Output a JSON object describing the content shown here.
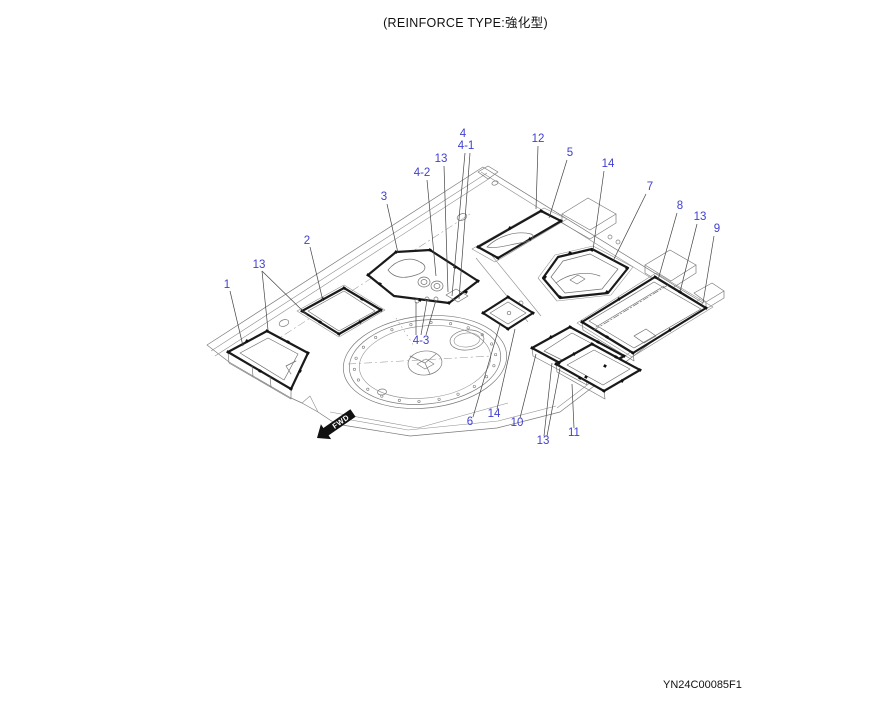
{
  "title": "(REINFORCE TYPE:強化型)",
  "drawing_number": "YN24C00085F1",
  "fwd_arrow": {
    "label": "FWD"
  },
  "colors": {
    "callout": "#4040d0",
    "line_thin": "#7a7a7a",
    "line_bold": "#1a1a1a",
    "background": "#ffffff"
  },
  "callouts": [
    {
      "label": "1",
      "x": 227,
      "y": 288,
      "leaders": [
        [
          230,
          291,
          243,
          346
        ]
      ]
    },
    {
      "label": "13",
      "x": 259,
      "y": 268,
      "leaders": [
        [
          262,
          271,
          268,
          330
        ],
        [
          262,
          271,
          308,
          316
        ]
      ]
    },
    {
      "label": "2",
      "x": 307,
      "y": 244,
      "leaders": [
        [
          310,
          247,
          323,
          301
        ]
      ]
    },
    {
      "label": "3",
      "x": 384,
      "y": 200,
      "leaders": [
        [
          387,
          204,
          398,
          253
        ]
      ]
    },
    {
      "label": "4-2",
      "x": 422,
      "y": 176,
      "leaders": [
        [
          427,
          180,
          436,
          276
        ]
      ]
    },
    {
      "label": "13",
      "x": 441,
      "y": 162,
      "leaders": [
        [
          444,
          166,
          448,
          292
        ]
      ]
    },
    {
      "label": "4",
      "x": 463,
      "y": 137,
      "leaders": [
        [
          465,
          153,
          452,
          296
        ]
      ]
    },
    {
      "label": "4-1",
      "x": 466,
      "y": 149,
      "leaders": [
        [
          470,
          153,
          459,
          299
        ]
      ]
    },
    {
      "label": "12",
      "x": 538,
      "y": 142,
      "leaders": [
        [
          538,
          146,
          536,
          209
        ]
      ]
    },
    {
      "label": "5",
      "x": 570,
      "y": 156,
      "leaders": [
        [
          567,
          160,
          549,
          218
        ]
      ]
    },
    {
      "label": "14",
      "x": 608,
      "y": 167,
      "leaders": [
        [
          604,
          171,
          593,
          250
        ]
      ]
    },
    {
      "label": "7",
      "x": 650,
      "y": 190,
      "leaders": [
        [
          646,
          194,
          613,
          261
        ]
      ]
    },
    {
      "label": "8",
      "x": 680,
      "y": 209,
      "leaders": [
        [
          677,
          213,
          658,
          280
        ]
      ]
    },
    {
      "label": "13",
      "x": 700,
      "y": 220,
      "leaders": [
        [
          697,
          224,
          680,
          292
        ]
      ]
    },
    {
      "label": "9",
      "x": 717,
      "y": 232,
      "leaders": [
        [
          714,
          236,
          703,
          303
        ]
      ]
    },
    {
      "label": "4-3",
      "x": 421,
      "y": 344,
      "leaders": [
        [
          416,
          335,
          416,
          302
        ],
        [
          421,
          335,
          427,
          300
        ],
        [
          426,
          335,
          436,
          300
        ]
      ]
    },
    {
      "label": "6",
      "x": 470,
      "y": 425,
      "leaders": [
        [
          473,
          417,
          500,
          324
        ]
      ]
    },
    {
      "label": "14",
      "x": 494,
      "y": 417,
      "leaders": [
        [
          497,
          409,
          515,
          329
        ]
      ]
    },
    {
      "label": "10",
      "x": 517,
      "y": 426,
      "leaders": [
        [
          520,
          418,
          536,
          354
        ]
      ]
    },
    {
      "label": "13",
      "x": 543,
      "y": 444,
      "leaders": [
        [
          544,
          436,
          552,
          363
        ],
        [
          547,
          436,
          560,
          368
        ]
      ]
    },
    {
      "label": "11",
      "x": 574,
      "y": 436,
      "leaders": [
        [
          574,
          428,
          572,
          384
        ]
      ]
    }
  ]
}
